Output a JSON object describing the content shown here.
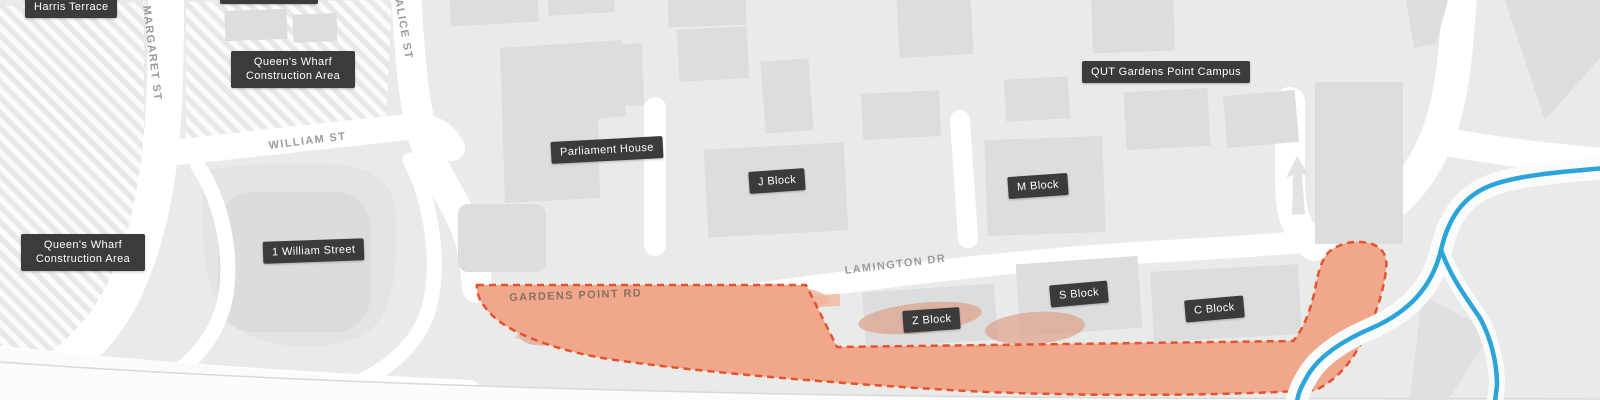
{
  "map": {
    "place_labels": [
      {
        "id": "harris-terrace",
        "text": "Harris Terrace"
      },
      {
        "id": "queens-wharf-north",
        "line1": "Queen's Wharf",
        "line2": "Construction Area"
      },
      {
        "id": "queens-wharf-west",
        "line1": "Queen's Wharf",
        "line2": "Construction Area"
      },
      {
        "id": "one-william-street",
        "text": "1 William Street"
      },
      {
        "id": "parliament-house",
        "text": "Parliament House"
      },
      {
        "id": "j-block",
        "text": "J Block"
      },
      {
        "id": "m-block",
        "text": "M Block"
      },
      {
        "id": "qut-gardens-point-campus",
        "text": "QUT Gardens Point Campus"
      },
      {
        "id": "z-block",
        "text": "Z Block"
      },
      {
        "id": "s-block",
        "text": "S Block"
      },
      {
        "id": "c-block",
        "text": "C Block"
      }
    ],
    "street_labels": [
      {
        "id": "margaret-st",
        "text": "MARGARET ST"
      },
      {
        "id": "alice-st",
        "text": "ALICE ST"
      },
      {
        "id": "william-st",
        "text": "WILLIAM ST"
      },
      {
        "id": "gardens-point-rd",
        "text": "GARDENS POINT RD"
      },
      {
        "id": "lamington-dr",
        "text": "LAMINGTON DR"
      }
    ],
    "colors": {
      "background": "#e9eaea",
      "building": "#dcdddd",
      "road": "#ffffff",
      "closure_fill": "#f1a78c",
      "closure_detail": "#dd8f72",
      "closure_border": "#e4532b",
      "water_line": "#2ba4da",
      "label_background": "#3b3b3b",
      "label_text": "#ffffff",
      "street_text": "#9b9b9b"
    }
  }
}
